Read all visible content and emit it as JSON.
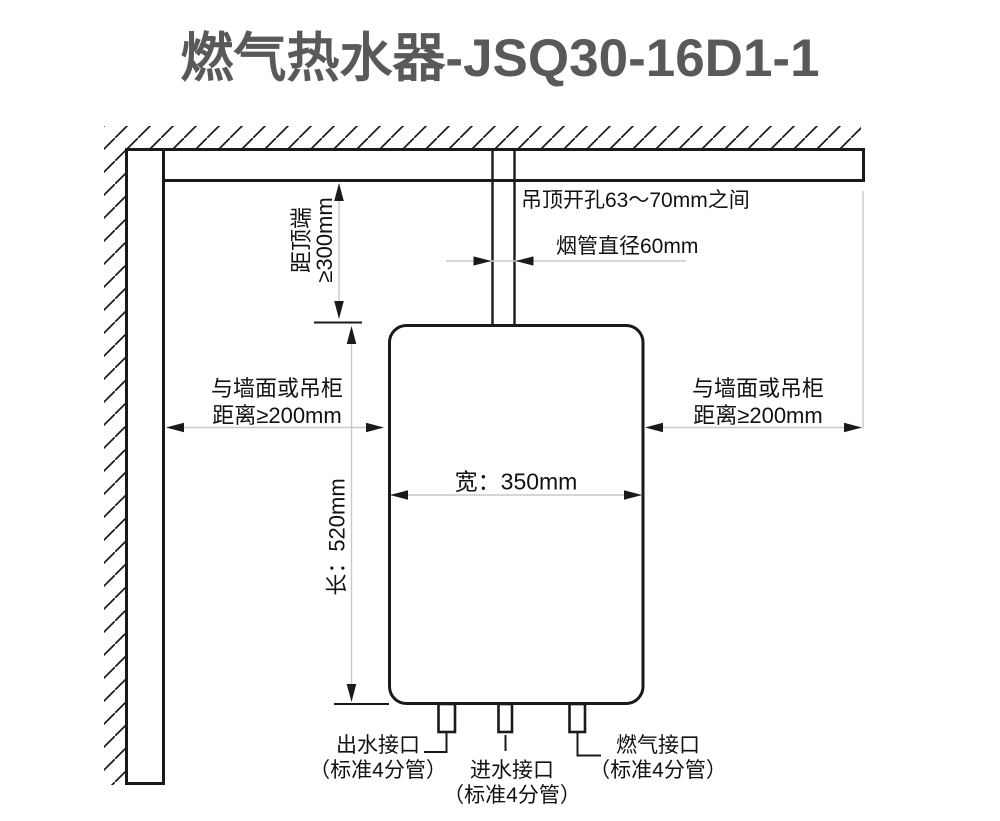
{
  "title": "燃气热水器-JSQ30-16D1-1",
  "colors": {
    "line": "#1a1a1a",
    "dimension_line": "#c9c9c9",
    "title_text": "#58595b",
    "background": "#ffffff"
  },
  "annotations": {
    "ceiling_hole": "吊顶开孔63～70mm之间",
    "flue_diameter": "烟管直径60mm",
    "top_clearance": {
      "line1": "距顶端",
      "line2": "≥300mm"
    },
    "left_clearance": {
      "line1": "与墙面或吊柜",
      "line2": "距离≥200mm"
    },
    "right_clearance": {
      "line1": "与墙面或吊柜",
      "line2": "距离≥200mm"
    },
    "width": "宽：350mm",
    "length": "长：520mm",
    "outlet": {
      "line1": "出水接口",
      "line2": "（标准4分管）"
    },
    "inlet": {
      "line1": "进水接口",
      "line2": "（标准4分管）"
    },
    "gas": {
      "line1": "燃气接口",
      "line2": "（标准4分管）"
    }
  }
}
